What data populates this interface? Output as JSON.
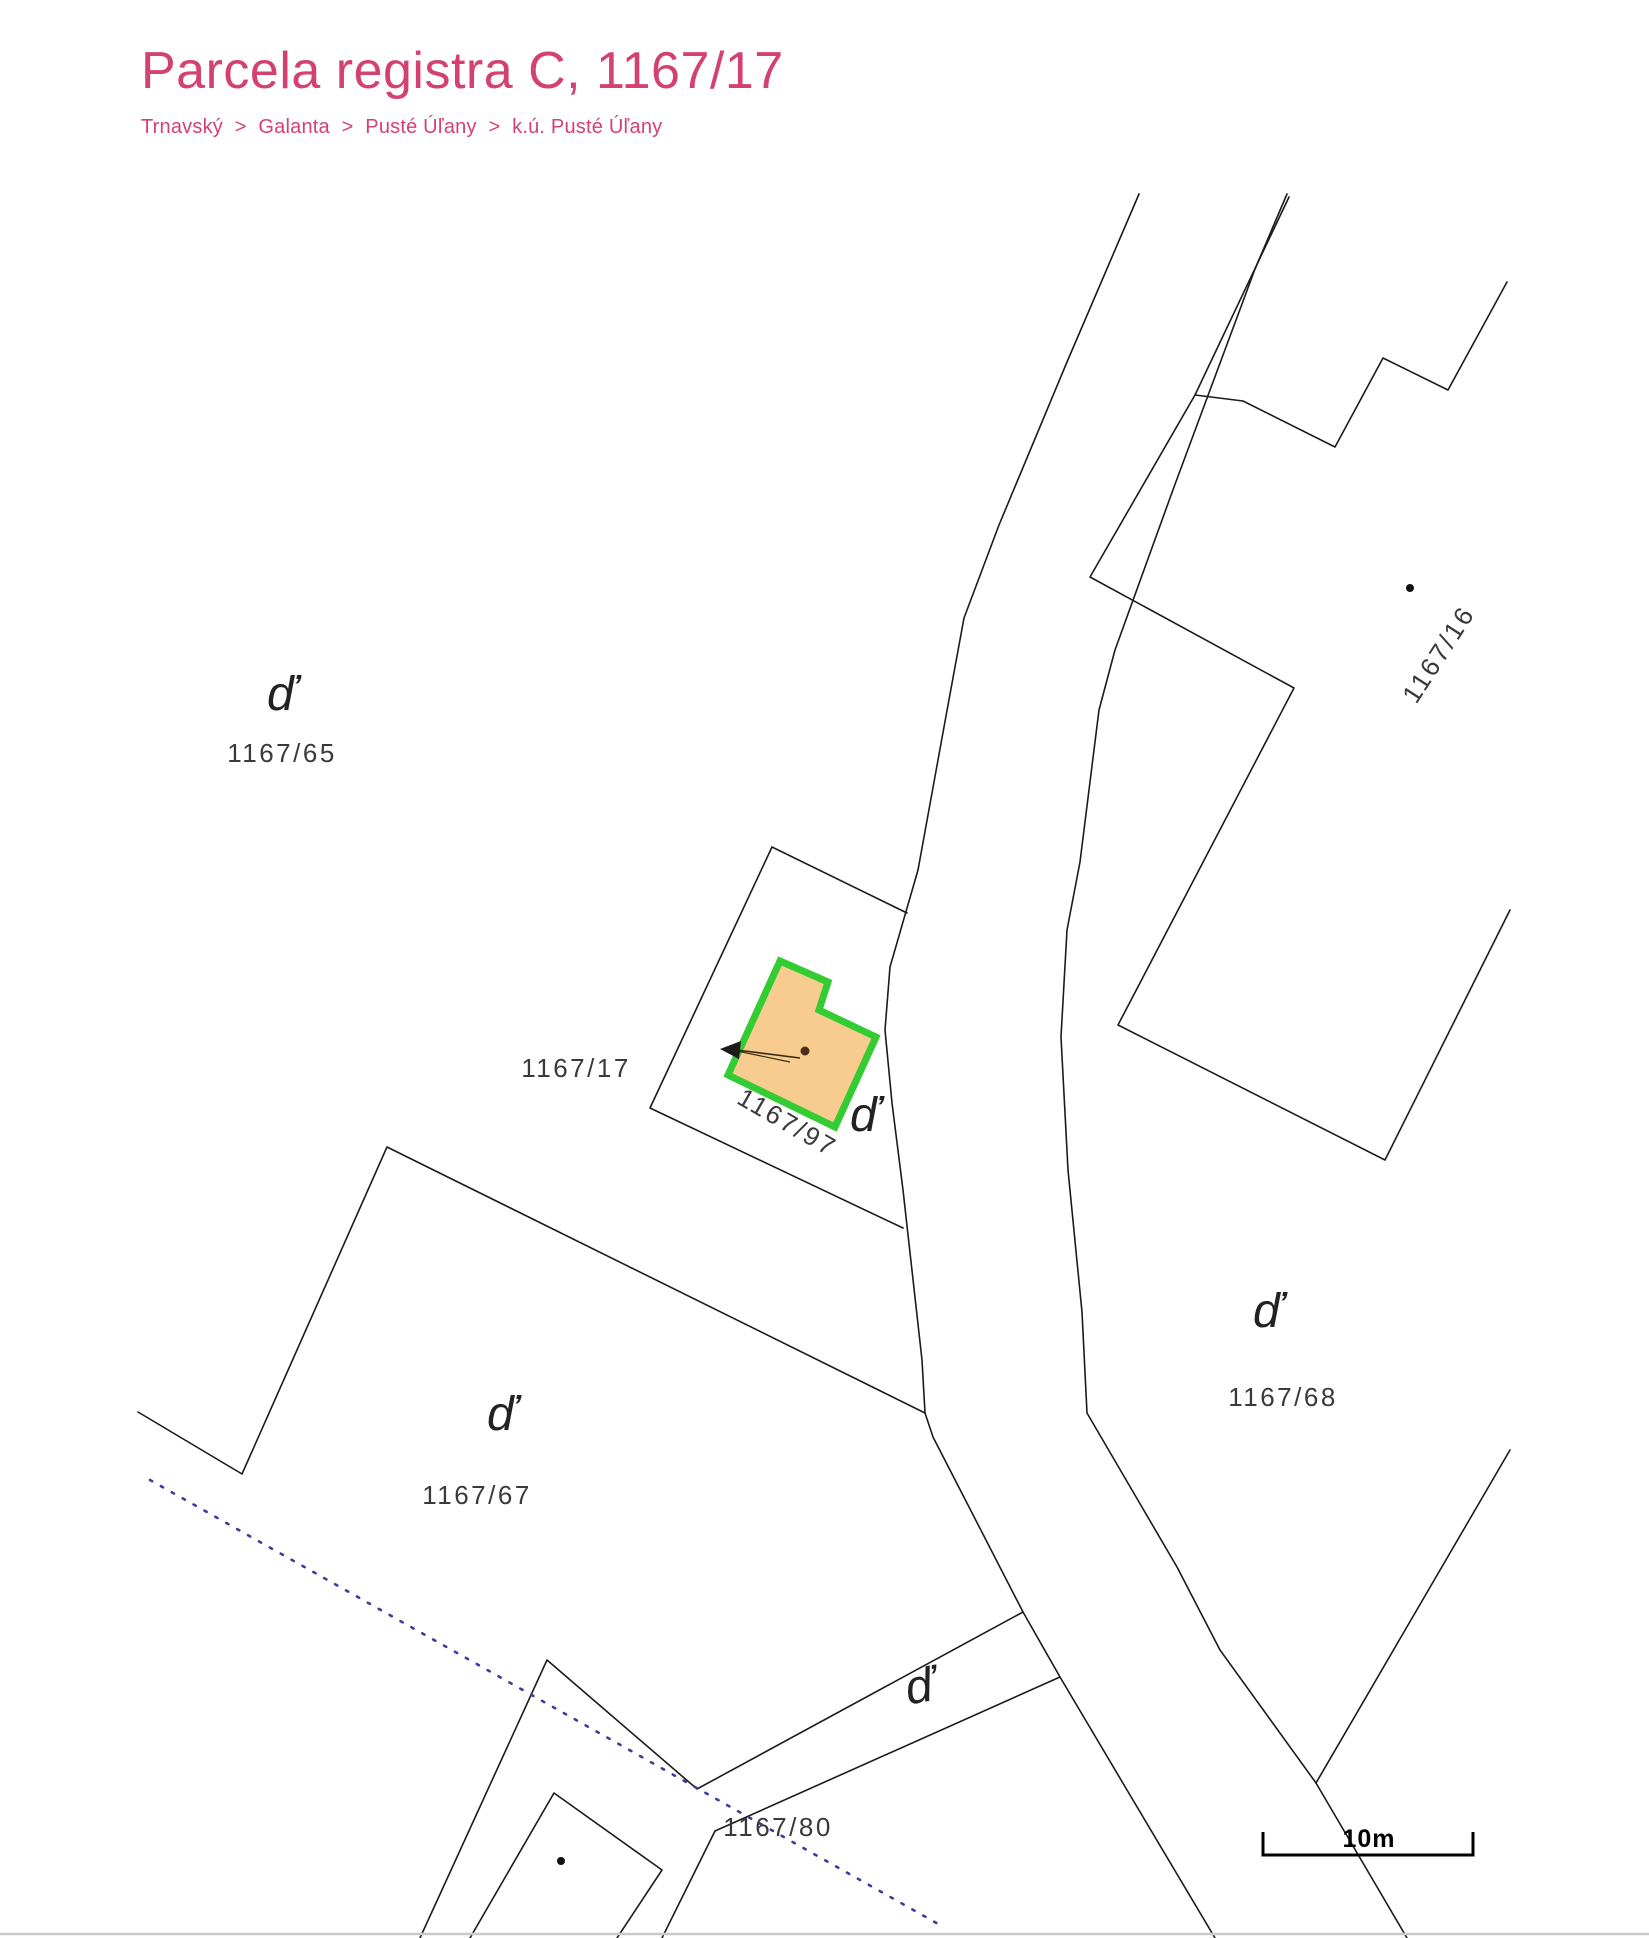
{
  "page": {
    "title": "Parcela registra C, 1167/17"
  },
  "breadcrumb": {
    "separator": ">",
    "items": [
      "Trnavský",
      "Galanta",
      "Pusté Úľany",
      "k.ú. Pusté Úľany"
    ]
  },
  "map": {
    "symbol_d": "ď",
    "labels": [
      {
        "text": "1167/65"
      },
      {
        "text": "1167/17"
      },
      {
        "text": "1167/97"
      },
      {
        "text": "1167/16"
      },
      {
        "text": "1167/68"
      },
      {
        "text": "1167/67"
      },
      {
        "text": "1167/80"
      }
    ],
    "selected_parcel": {
      "id": "1167/17",
      "fill_color": "#f7cc8e",
      "outline_color": "#33cc33"
    },
    "scale": {
      "label": "10m"
    },
    "colors": {
      "accent_pink": "#d4416f",
      "boundary_line": "#1b1b1b",
      "dotted_boundary": "#3c3c9e"
    }
  }
}
